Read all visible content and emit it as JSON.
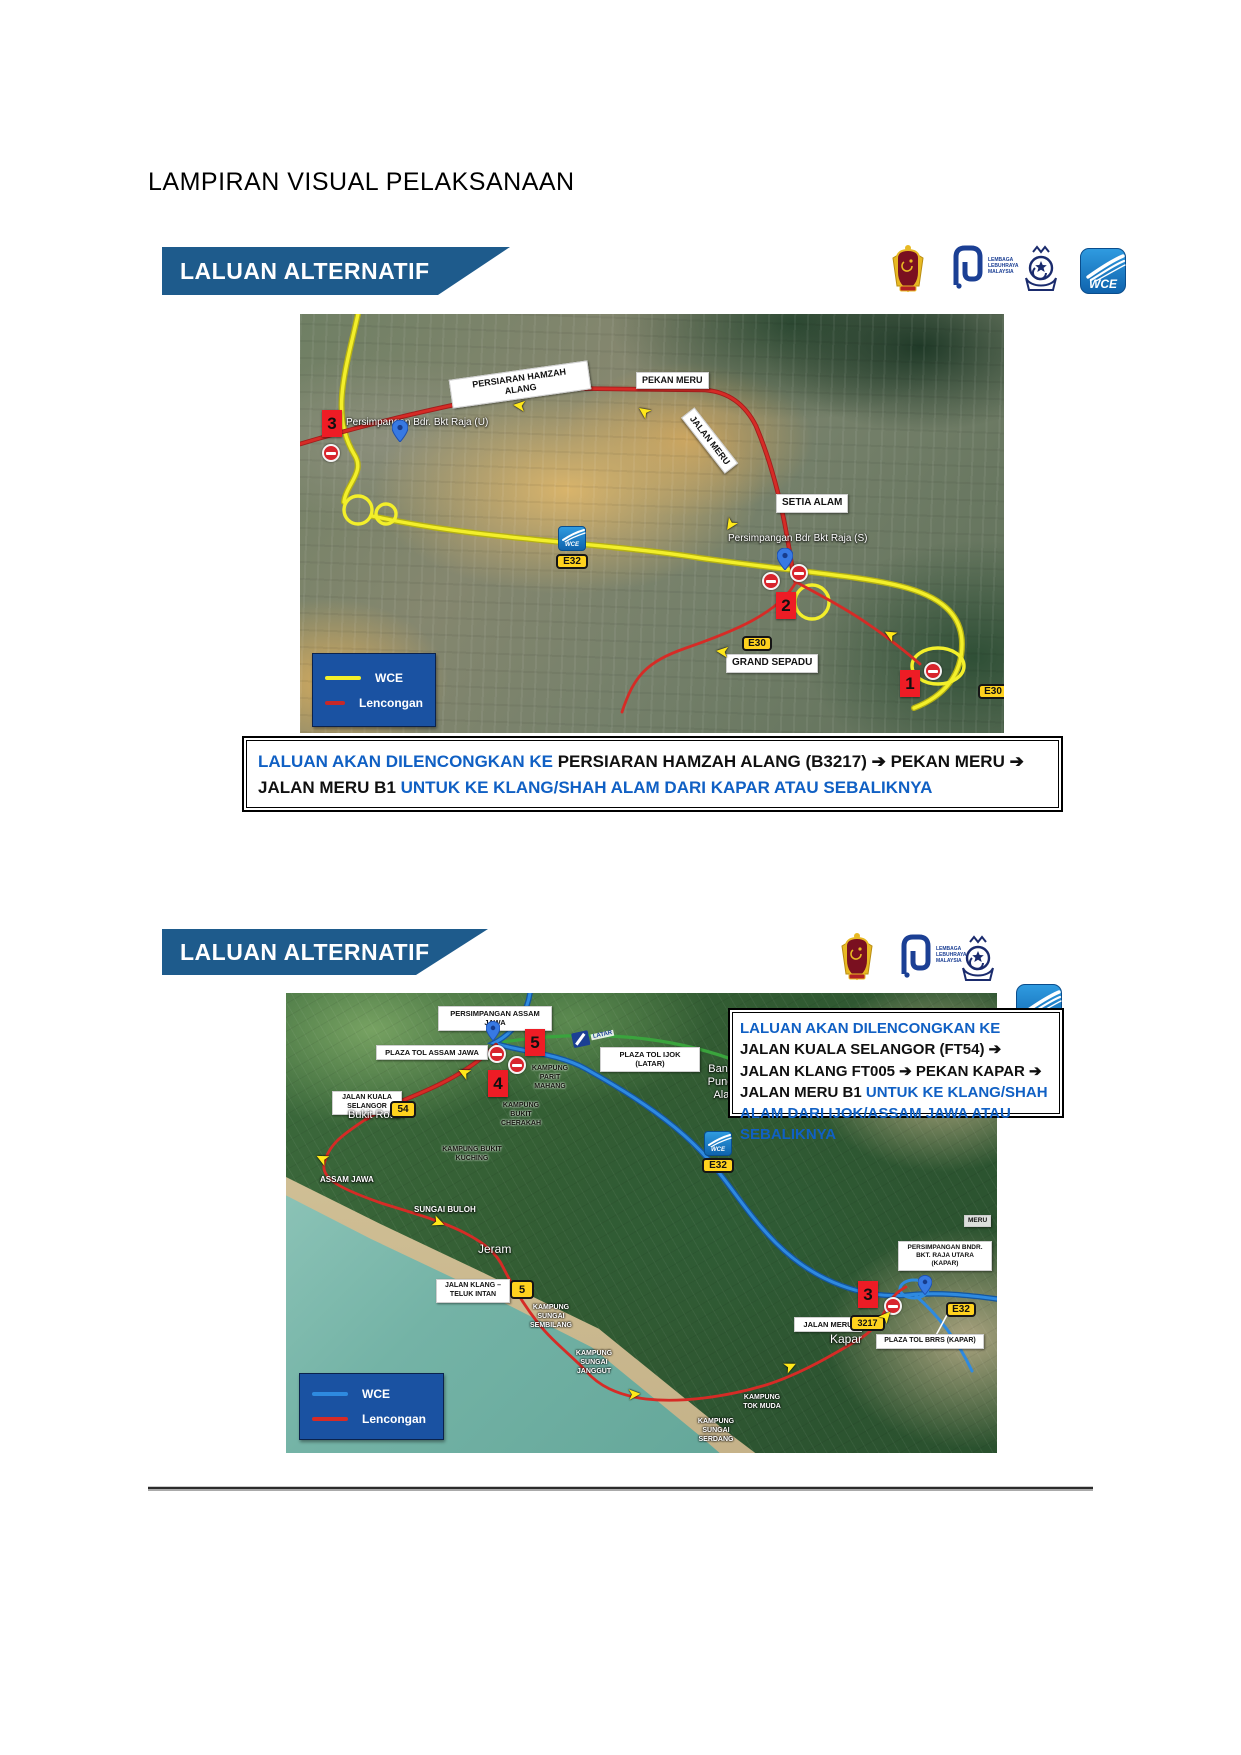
{
  "page": {
    "title": "LAMPIRAN VISUAL PELAKSANAAN"
  },
  "colors": {
    "banner_blue": "#1e5b8c",
    "legend_blue": "#1a52a2",
    "caption_blue": "#1060c4",
    "marker_red": "#ee1c25",
    "shield_yellow": "#ffd21e",
    "wce_route_yellow": "#f3ef2a",
    "wce_route_blue": "#2e8ae0",
    "detour_red": "#d62b26",
    "latar_route_green": "#3aa43d"
  },
  "logos": {
    "llm_text": "LEMBAGA\nLEBUHRAYA\nMALAYSIA",
    "wce_text": "WCE",
    "latar_text": "LATAR"
  },
  "section1": {
    "banner": "LALUAN ALTERNATIF",
    "legend": {
      "line1": "WCE",
      "line2": "Lencongan"
    },
    "caption": {
      "part1": "LALUAN AKAN DILENCONGKAN KE ",
      "part2": "PERSIARAN HAMZAH ALANG (B3217) ➔ PEKAN MERU ➔ JALAN MERU B1 ",
      "part3": "UNTUK KE KLANG/SHAH ALAM DARI KAPAR ATAU SEBALIKNYA"
    },
    "map": {
      "labels": {
        "persiaran_hamzah_alang": "PERSIARAN HAMZAH ALANG",
        "pekan_meru": "PEKAN MERU",
        "jalan_meru": "JALAN MERU",
        "setia_alam": "SETIA ALAM",
        "grand_sepadu": "GRAND SEPADU",
        "persimpangan_u": "Persimpangan Bdr. Bkt Raja (U)",
        "persimpangan_s": "Persimpangan Bdr Bkt Raja (S)"
      },
      "markers": {
        "m1": "1",
        "m2": "2",
        "m3": "3"
      },
      "shields": {
        "e30_west": "E30",
        "e30_east": "E30",
        "e32": "E32",
        "wce": "WCE"
      }
    }
  },
  "section2": {
    "banner": "LALUAN ALTERNATIF",
    "legend": {
      "line1": "WCE",
      "line2": "Lencongan"
    },
    "caption": {
      "part1": "LALUAN AKAN DILENCONGKAN KE ",
      "part2": "JALAN KUALA SELANGOR (FT54) ➔ JALAN KLANG FT005 ➔ PEKAN KAPAR ➔ JALAN MERU B1 ",
      "part3": "UNTUK KE KLANG/SHAH ALAM DARI IJOK/ASSAM JAWA ATAU SEBALIKNYA"
    },
    "map": {
      "labels": {
        "persimpangan_assam_jawa": "PERSIMPANGAN ASSAM JAWA",
        "plaza_tol_assam_jawa": "PLAZA TOL ASSAM JAWA",
        "plaza_tol_ijok": "PLAZA TOL IJOK (LATAR)",
        "jalan_kuala_selangor": "JALAN KUALA SELANGOR",
        "jalan_klang_teluk_intan": "JALAN KLANG – TELUK INTAN",
        "jalan_meru": "JALAN MERU",
        "plaza_tol_brrs": "PLAZA TOL BRRS (KAPAR)",
        "persimpangan_bndr": "PERSIMPANGAN BNDR. BKT. RAJA UTARA (KAPAR)",
        "kampung_parit_mahang": "KAMPUNG PARIT MAHANG",
        "kampung_bukit_cherakah": "KAMPUNG BUKIT CHERAKAH",
        "kampung_bukit_kuching": "KAMPUNG BUKIT KUCHING",
        "kampung_sungai_sembilang": "KAMPUNG SUNGAI SEMBILANG",
        "kampung_sungai_janggut": "KAMPUNG SUNGAI JANGGUT",
        "kampung_tok_muda": "KAMPUNG TOK MUDA",
        "kampung_sungai_serdang": "KAMPUNG SUNGAI SERDANG",
        "bukit_rotan": "Bukit Rotan",
        "assam_jawa": "ASSAM JAWA",
        "sungai_buloh": "SUNGAI BULOH",
        "jeram": "Jeram",
        "kapar": "Kapar",
        "bandar_puncak_alam": "Bandar Puncak Alam",
        "meru": "MERU"
      },
      "markers": {
        "m3": "3",
        "m4": "4",
        "m5": "5"
      },
      "shields": {
        "s54": "54",
        "s5": "5",
        "s3217": "3217",
        "e32_mid": "E32",
        "e32_kapar": "E32",
        "wce": "WCE"
      }
    }
  }
}
